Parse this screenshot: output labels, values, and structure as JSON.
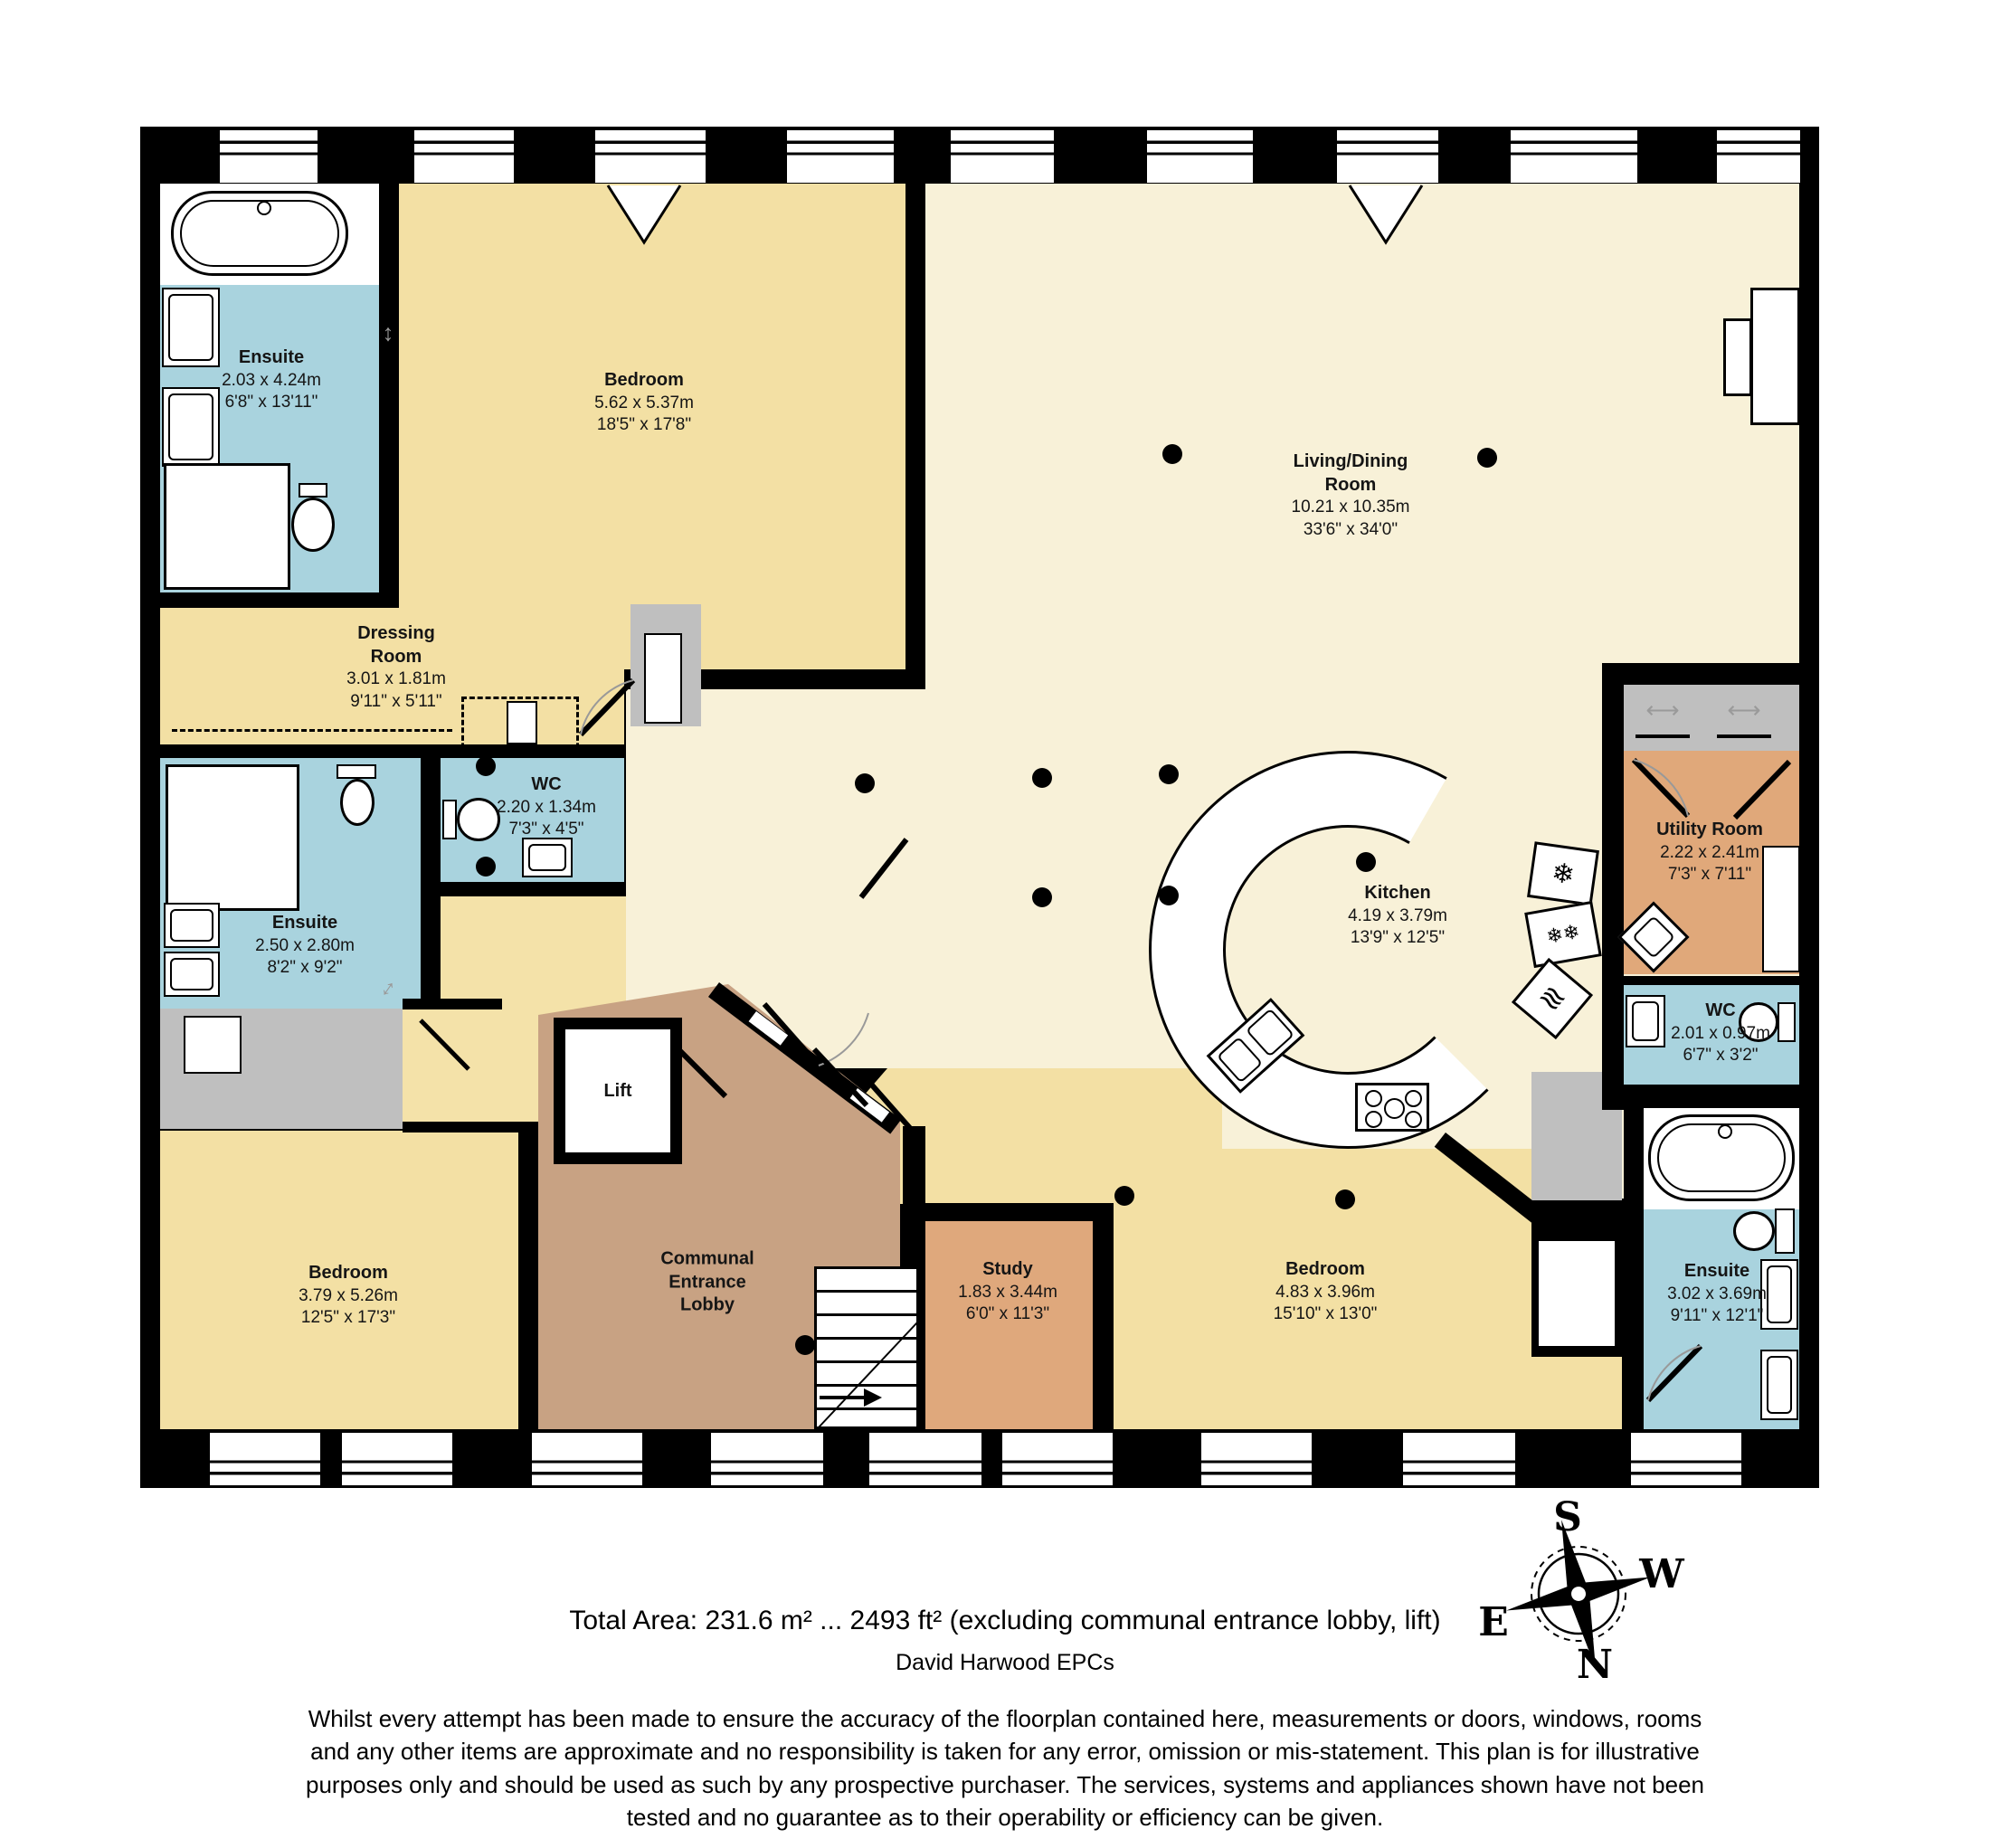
{
  "plan_title": "Floorplan",
  "colors": {
    "wall": "#000000",
    "bathroom_blue": "#a9d3de",
    "bedroom_yellow": "#f3e0a4",
    "living_cream": "#f8f1d8",
    "corridor_yellow": "#f4e2a9",
    "lobby_brown": "#c8a283",
    "study_orange": "#dfa87c",
    "utility_orange": "#e0a87a",
    "closet_grey": "#bfbfbf"
  },
  "rooms": [
    {
      "name": "Ensuite",
      "dims_m": "2.03 x 4.24m",
      "dims_ft": "6'8\" x 13'11\""
    },
    {
      "name": "Bedroom",
      "dims_m": "5.62 x 5.37m",
      "dims_ft": "18'5\" x 17'8\""
    },
    {
      "name": "Living/Dining Room",
      "dims_m": "10.21 x 10.35m",
      "dims_ft": "33'6\" x 34'0\""
    },
    {
      "name": "Dressing Room",
      "dims_m": "3.01 x 1.81m",
      "dims_ft": "9'11\" x 5'11\""
    },
    {
      "name": "WC",
      "dims_m": "2.20 x 1.34m",
      "dims_ft": "7'3\" x 4'5\""
    },
    {
      "name": "Ensuite",
      "dims_m": "2.50 x 2.80m",
      "dims_ft": "8'2\" x 9'2\""
    },
    {
      "name": "Bedroom",
      "dims_m": "3.79 x 5.26m",
      "dims_ft": "12'5\" x 17'3\""
    },
    {
      "name": "Lift",
      "dims_m": "",
      "dims_ft": ""
    },
    {
      "name": "Communal Entrance Lobby",
      "dims_m": "",
      "dims_ft": ""
    },
    {
      "name": "Study",
      "dims_m": "1.83 x 3.44m",
      "dims_ft": "6'0\" x 11'3\""
    },
    {
      "name": "Bedroom",
      "dims_m": "4.83 x 3.96m",
      "dims_ft": "15'10\" x 13'0\""
    },
    {
      "name": "Kitchen",
      "dims_m": "4.19 x 3.79m",
      "dims_ft": "13'9\" x 12'5\""
    },
    {
      "name": "Utility Room",
      "dims_m": "2.22 x 2.41m",
      "dims_ft": "7'3\" x 7'11\""
    },
    {
      "name": "WC",
      "dims_m": "2.01 x 0.97m",
      "dims_ft": "6'7\" x 3'2\""
    },
    {
      "name": "Ensuite",
      "dims_m": "3.02 x 3.69m",
      "dims_ft": "9'11\" x 12'1\""
    }
  ],
  "compass": {
    "north": "N",
    "south": "S",
    "east": "E",
    "west": "W"
  },
  "footer": {
    "total_area": "Total Area: 231.6 m² ... 2493 ft² (excluding communal entrance lobby, lift)",
    "credit": "David Harwood EPCs",
    "disclaimer": "Whilst every attempt has been made to ensure the accuracy of the floorplan contained here, measurements or doors, windows, rooms and any other items are approximate and no responsibility is taken for any error, omission or mis-statement. This plan is for illustrative purposes only and should be used as such by any prospective purchaser. The services, systems and appliances shown have not been tested and no guarantee as to their operability or efficiency can be given."
  }
}
